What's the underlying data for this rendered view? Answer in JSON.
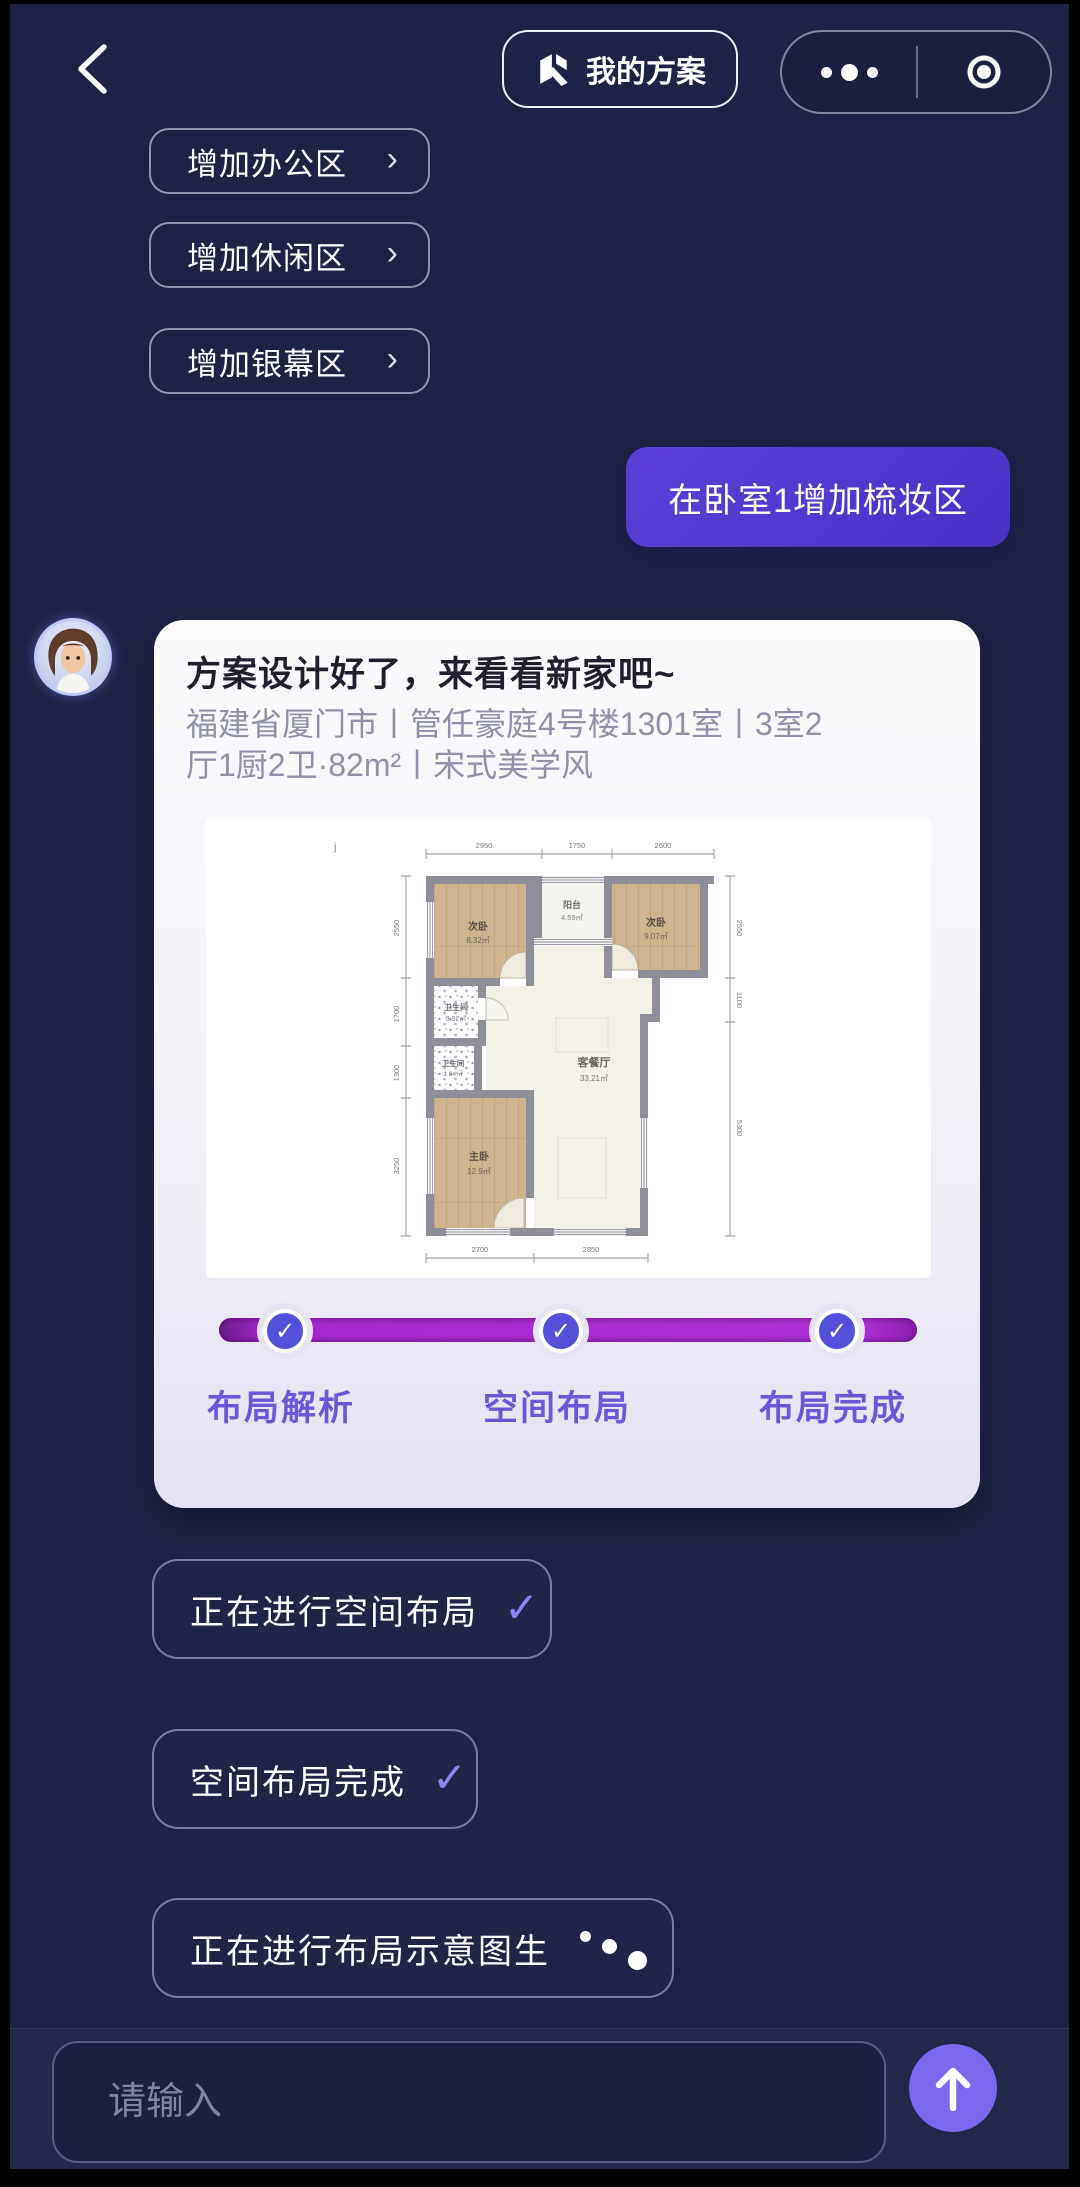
{
  "header": {
    "back_icon": "‹",
    "plan_button_label": "我的方案",
    "plan_button_icon": "plan-logo",
    "capsule": {
      "more_icon": "•••",
      "indicator_icon": "◎"
    }
  },
  "suggestions": [
    {
      "label": "增加办公区",
      "chevron": "›"
    },
    {
      "label": "增加休闲区",
      "chevron": "›"
    },
    {
      "label": "增加银幕区",
      "chevron": "›"
    }
  ],
  "user_message": {
    "text": "在卧室1增加梳妆区"
  },
  "assistant_card": {
    "title": "方案设计好了，来看看新家吧~",
    "subtitle_line1": "福建省厦门市丨管任豪庭4号楼1301室丨3室2",
    "subtitle_line2": "厅1厨2卫·82m²丨宋式美学风",
    "floorplan": {
      "corner_mark": "j",
      "rooms": {
        "bed_tl": {
          "name": "次卧",
          "area": "8.32㎡"
        },
        "balcony": {
          "name": "阳台",
          "area": "4.59㎡"
        },
        "bed_tr": {
          "name": "次卧",
          "area": "9.07㎡"
        },
        "bath1": {
          "name": "卫生间",
          "area": "3.92㎡"
        },
        "bath2": {
          "name": "卫生间",
          "area": "1.84㎡"
        },
        "master": {
          "name": "主卧",
          "area": "12.9㎡"
        },
        "living": {
          "name": "客餐厅",
          "area": "33.21㎡"
        }
      },
      "dims": {
        "top": [
          "2950",
          "1750",
          "2600"
        ],
        "left": [
          "2550",
          "1700",
          "1300",
          "3250"
        ],
        "right": [
          "2550",
          "1100",
          "5300"
        ],
        "bottom": [
          "2700",
          "2850"
        ]
      }
    },
    "progress": {
      "steps": [
        {
          "label": "布局解析",
          "check": "✓"
        },
        {
          "label": "空间布局",
          "check": "✓"
        },
        {
          "label": "布局完成",
          "check": "✓"
        }
      ]
    }
  },
  "status_messages": [
    {
      "text": "正在进行空间布局",
      "check": "✓"
    },
    {
      "text": "空间布局完成",
      "check": "✓"
    },
    {
      "text": "正在进行布局示意图生",
      "loading": "dots"
    }
  ],
  "composer": {
    "placeholder": "请输入",
    "send_icon": "↑"
  },
  "colors": {
    "background": "#1e2244",
    "bubble_purple": "#5138d0",
    "progress_magenta": "#a82bd2",
    "check_circle_blue": "#5450da",
    "step_label_purple": "#6b58d6",
    "send_purple": "#7b68ef",
    "card_light": "#f2f1f8"
  }
}
